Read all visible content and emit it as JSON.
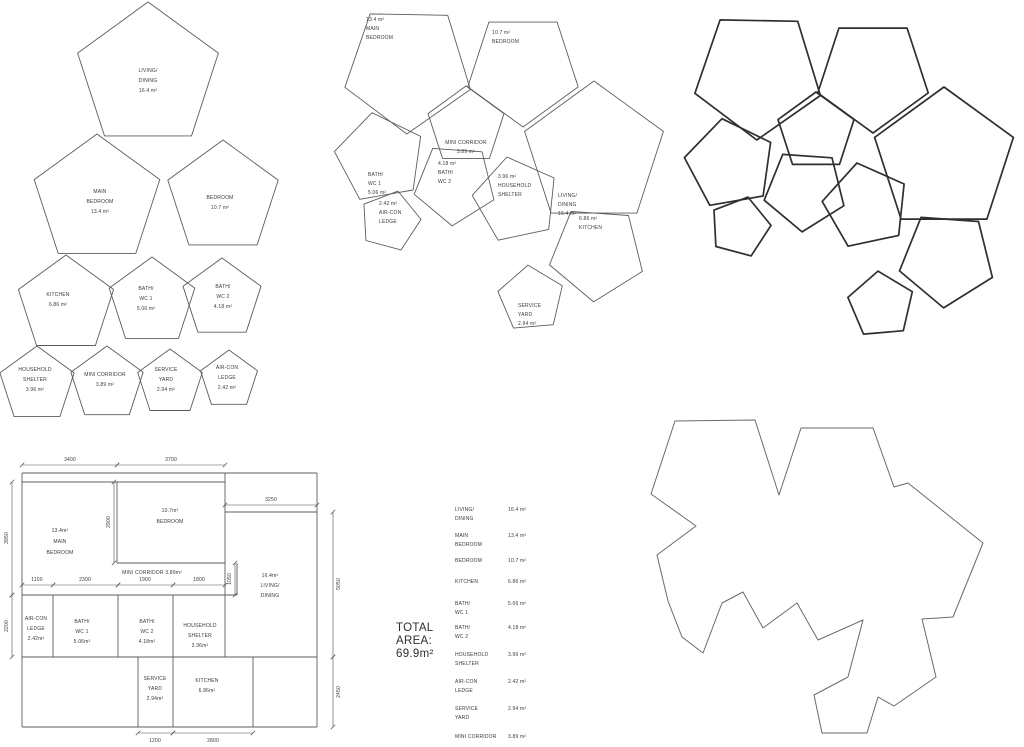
{
  "colors": {
    "thin_line": "#5c5c5c",
    "thick_line": "#2f2f2f",
    "outline_line": "#6a6a6a",
    "text": "#3a3a3a",
    "dim_line": "#4f4f4f"
  },
  "exploded_view": {
    "pentagons": [
      {
        "id": "living-dining",
        "cx": 148,
        "cy": 76,
        "r": 74,
        "rot": 0,
        "label": {
          "x": 148,
          "y": 72,
          "anchor": "middle",
          "step": 10,
          "lines": [
            "LIVING/",
            "DINING",
            "16.4 m²"
          ]
        }
      },
      {
        "id": "main-bedroom",
        "cx": 97,
        "cy": 200,
        "r": 66,
        "rot": 0,
        "label": {
          "x": 100,
          "y": 193,
          "anchor": "middle",
          "step": 10,
          "lines": [
            "MAIN",
            "BEDROOM",
            "13.4 m²"
          ]
        }
      },
      {
        "id": "bedroom",
        "cx": 223,
        "cy": 198,
        "r": 58,
        "rot": 0,
        "label": {
          "x": 220,
          "y": 199,
          "anchor": "middle",
          "step": 10,
          "lines": [
            "BEDROOM",
            "10.7 m²"
          ]
        }
      },
      {
        "id": "kitchen",
        "cx": 66,
        "cy": 305,
        "r": 50,
        "rot": 0,
        "label": {
          "x": 58,
          "y": 296,
          "anchor": "middle",
          "step": 10,
          "lines": [
            "KITCHEN",
            "6.86 m²"
          ]
        }
      },
      {
        "id": "bath-wc-1",
        "cx": 152,
        "cy": 302,
        "r": 45,
        "rot": 0,
        "label": {
          "x": 146,
          "y": 290,
          "anchor": "middle",
          "step": 10,
          "lines": [
            "BATH/",
            "WC 1",
            "5.06 m²"
          ]
        }
      },
      {
        "id": "bath-wc-2",
        "cx": 222,
        "cy": 299,
        "r": 41,
        "rot": 0,
        "label": {
          "x": 223,
          "y": 288,
          "anchor": "middle",
          "step": 10,
          "lines": [
            "BATH/",
            "WC 2",
            "4.18 m²"
          ]
        }
      },
      {
        "id": "household-shelter",
        "cx": 37,
        "cy": 385,
        "r": 39,
        "rot": 0,
        "label": {
          "x": 35,
          "y": 371,
          "anchor": "middle",
          "step": 10,
          "lines": [
            "HOUSEHOLD",
            "SHELTER",
            "3.96 m²"
          ]
        }
      },
      {
        "id": "mini-corridor",
        "cx": 107,
        "cy": 384,
        "r": 38,
        "rot": 0,
        "label": {
          "x": 105,
          "y": 376,
          "anchor": "middle",
          "step": 10,
          "lines": [
            "MINI CORRIDOR",
            "3.89 m²"
          ]
        }
      },
      {
        "id": "service-yard",
        "cx": 170,
        "cy": 383,
        "r": 34,
        "rot": 0,
        "label": {
          "x": 166,
          "y": 371,
          "anchor": "middle",
          "step": 10,
          "lines": [
            "SERVICE",
            "YARD",
            "2.94 m²"
          ]
        }
      },
      {
        "id": "air-con-ledge",
        "cx": 229,
        "cy": 380,
        "r": 30,
        "rot": 0,
        "label": {
          "x": 227,
          "y": 369,
          "anchor": "middle",
          "step": 10,
          "lines": [
            "AIR-CON",
            "LEDGE",
            "2.42 m²"
          ]
        }
      }
    ]
  },
  "assembled_view": {
    "pentagons": [
      {
        "id": "main-bedroom",
        "cx": 408,
        "cy": 68,
        "r": 66,
        "rot": 37,
        "label": {
          "x": 366,
          "y": 21,
          "anchor": "start",
          "step": 9,
          "lines": [
            "13.4 m²",
            "MAIN",
            "BEDROOM"
          ]
        }
      },
      {
        "id": "bedroom",
        "cx": 523,
        "cy": 69,
        "r": 58,
        "rot": 36,
        "label": {
          "x": 492,
          "y": 34,
          "anchor": "start",
          "step": 9,
          "lines": [
            "10.7 m²",
            "BEDROOM"
          ]
        }
      },
      {
        "id": "mini-corridor",
        "cx": 466,
        "cy": 126,
        "r": 40,
        "rot": 0,
        "label": {
          "x": 466,
          "y": 144,
          "anchor": "middle",
          "step": 9,
          "lines": [
            "MINI CORRIDOR",
            "3.89 m²"
          ]
        }
      },
      {
        "id": "bath-wc-1",
        "cx": 380,
        "cy": 158,
        "r": 46,
        "rot": -10,
        "label": {
          "x": 368,
          "y": 176,
          "anchor": "start",
          "step": 9,
          "lines": [
            "BATH/",
            "WC 1",
            "5.06 m²"
          ]
        }
      },
      {
        "id": "air-con-ledge",
        "cx": 390,
        "cy": 221,
        "r": 31,
        "rot": 15,
        "label": {
          "x": 379,
          "y": 205,
          "anchor": "start",
          "step": 9,
          "lines": [
            "2.42 m²",
            "AIR-CON",
            "LEDGE"
          ]
        }
      },
      {
        "id": "bath-wc-2",
        "cx": 455,
        "cy": 184,
        "r": 42,
        "rot": 40,
        "label": {
          "x": 438,
          "y": 165,
          "anchor": "start",
          "step": 9,
          "lines": [
            "4.18 m²",
            "BATH/",
            "WC 2"
          ]
        }
      },
      {
        "id": "household-shelter",
        "cx": 516,
        "cy": 200,
        "r": 44,
        "rot": -12,
        "label": {
          "x": 498,
          "y": 178,
          "anchor": "start",
          "step": 9,
          "lines": [
            "3.96 m²",
            "HOUSEHOLD",
            "SHELTER"
          ]
        }
      },
      {
        "id": "living-dining",
        "cx": 594,
        "cy": 154,
        "r": 73,
        "rot": 0,
        "label": {
          "x": 558,
          "y": 197,
          "anchor": "start",
          "step": 9,
          "lines": [
            "LIVING/",
            "DINING",
            "16.4 m²"
          ]
        }
      },
      {
        "id": "kitchen",
        "cx": 597,
        "cy": 253,
        "r": 49,
        "rot": 40,
        "label": {
          "x": 579,
          "y": 220,
          "anchor": "start",
          "step": 9,
          "lines": [
            "6.86 m²",
            "KITCHEN"
          ]
        }
      },
      {
        "id": "service-yard",
        "cx": 531,
        "cy": 299,
        "r": 34,
        "rot": -5,
        "label": {
          "x": 518,
          "y": 307,
          "anchor": "start",
          "step": 9,
          "lines": [
            "SERVICE",
            "YARD",
            "2.94 m²"
          ]
        }
      }
    ]
  },
  "outline_view": {
    "dx": 350,
    "dy": 6
  },
  "floor_plan": {
    "walls": [
      [
        22,
        473,
        317,
        473
      ],
      [
        22,
        482,
        225,
        482
      ],
      [
        225,
        512,
        317,
        512
      ],
      [
        117,
        563,
        225,
        563
      ],
      [
        22,
        595,
        237,
        595
      ],
      [
        22,
        657,
        317,
        657
      ],
      [
        22,
        727,
        317,
        727
      ],
      [
        22,
        473,
        22,
        727
      ],
      [
        317,
        473,
        317,
        727
      ],
      [
        117,
        482,
        117,
        563
      ],
      [
        225,
        473,
        225,
        657
      ],
      [
        237,
        563,
        237,
        595
      ],
      [
        53,
        595,
        53,
        657
      ],
      [
        118,
        595,
        118,
        657
      ],
      [
        173,
        595,
        173,
        657
      ],
      [
        138,
        657,
        138,
        727
      ],
      [
        173,
        657,
        173,
        727
      ],
      [
        253,
        657,
        253,
        727
      ]
    ],
    "dims": [
      {
        "x1": 22,
        "y1": 465,
        "x2": 117,
        "y2": 465,
        "label": "3400",
        "lx": 70,
        "ly": 461,
        "rot": 0
      },
      {
        "x1": 117,
        "y1": 465,
        "x2": 225,
        "y2": 465,
        "label": "3700",
        "lx": 171,
        "ly": 461,
        "rot": 0
      },
      {
        "x1": 225,
        "y1": 505,
        "x2": 317,
        "y2": 505,
        "label": "3250",
        "lx": 271,
        "ly": 501,
        "rot": 0
      },
      {
        "x1": 12,
        "y1": 482,
        "x2": 12,
        "y2": 595,
        "label": "3950",
        "lx": 8,
        "ly": 538,
        "rot": -90
      },
      {
        "x1": 12,
        "y1": 595,
        "x2": 12,
        "y2": 657,
        "label": "2200",
        "lx": 8,
        "ly": 626,
        "rot": -90
      },
      {
        "x1": 333,
        "y1": 512,
        "x2": 333,
        "y2": 657,
        "label": "5050",
        "lx": 340,
        "ly": 584,
        "rot": -90
      },
      {
        "x1": 333,
        "y1": 657,
        "x2": 333,
        "y2": 727,
        "label": "2450",
        "lx": 340,
        "ly": 692,
        "rot": -90
      },
      {
        "x1": 114,
        "y1": 482,
        "x2": 114,
        "y2": 563,
        "label": "2900",
        "lx": 110,
        "ly": 522,
        "rot": -90
      },
      {
        "x1": 235,
        "y1": 563,
        "x2": 235,
        "y2": 595,
        "label": "1050",
        "lx": 231,
        "ly": 579,
        "rot": -90
      },
      {
        "x1": 22,
        "y1": 585,
        "x2": 53,
        "y2": 585,
        "label": "1100",
        "lx": 37,
        "ly": 581,
        "rot": 0
      },
      {
        "x1": 53,
        "y1": 585,
        "x2": 118,
        "y2": 585,
        "label": "2300",
        "lx": 85,
        "ly": 581,
        "rot": 0
      },
      {
        "x1": 118,
        "y1": 585,
        "x2": 173,
        "y2": 585,
        "label": "1900",
        "lx": 145,
        "ly": 581,
        "rot": 0
      },
      {
        "x1": 173,
        "y1": 585,
        "x2": 225,
        "y2": 585,
        "label": "1800",
        "lx": 199,
        "ly": 581,
        "rot": 0
      },
      {
        "x1": 138,
        "y1": 733,
        "x2": 173,
        "y2": 733,
        "label": "1200",
        "lx": 155,
        "ly": 742,
        "rot": 0
      },
      {
        "x1": 173,
        "y1": 733,
        "x2": 253,
        "y2": 733,
        "label": "2800",
        "lx": 213,
        "ly": 742,
        "rot": 0
      }
    ],
    "rooms": [
      {
        "id": "main-bedroom",
        "x": 60,
        "y": 532,
        "step": 11,
        "lines": [
          "13.4m²",
          "MAIN",
          "BEDROOM"
        ]
      },
      {
        "id": "bedroom",
        "x": 170,
        "y": 512,
        "step": 11,
        "lines": [
          "10.7m²",
          "BEDROOM"
        ]
      },
      {
        "id": "mini-corridor",
        "x": 152,
        "y": 574,
        "step": 10,
        "lines": [
          "MINI CORRIDOR 3.89m²"
        ]
      },
      {
        "id": "living-dining",
        "x": 270,
        "y": 577,
        "step": 10,
        "lines": [
          "16.4m²",
          "LIVING/",
          "DINING"
        ]
      },
      {
        "id": "air-con-ledge",
        "x": 36,
        "y": 620,
        "step": 10,
        "lines": [
          "AIR-CON",
          "LEDGE",
          "2.42m²"
        ]
      },
      {
        "id": "bath-wc-1",
        "x": 82,
        "y": 623,
        "step": 10,
        "lines": [
          "BATH/",
          "WC 1",
          "5.06m²"
        ]
      },
      {
        "id": "bath-wc-2",
        "x": 147,
        "y": 623,
        "step": 10,
        "lines": [
          "BATH/",
          "WC 2",
          "4.18m²"
        ]
      },
      {
        "id": "household-shelter",
        "x": 200,
        "y": 627,
        "step": 10,
        "lines": [
          "HOUSEHOLD",
          "SHELTER",
          "3.96m²"
        ]
      },
      {
        "id": "service-yard",
        "x": 155,
        "y": 680,
        "step": 10,
        "lines": [
          "SERVICE",
          "YARD",
          "2.94m²"
        ]
      },
      {
        "id": "kitchen",
        "x": 207,
        "y": 682,
        "step": 10,
        "lines": [
          "KITCHEN",
          "6.86m²"
        ]
      }
    ]
  },
  "area_table": {
    "total_lines": [
      "TOTAL",
      "AREA:",
      "69.9m²"
    ],
    "label_x": 455,
    "value_x": 508,
    "step": 9,
    "rows": [
      {
        "lines": [
          "LIVING/",
          "DINING"
        ],
        "value": "16.4 m²",
        "y": 511
      },
      {
        "lines": [
          "MAIN",
          "BEDROOM"
        ],
        "value": "13.4 m²",
        "y": 537
      },
      {
        "lines": [
          "BEDROOM"
        ],
        "value": "10.7 m²",
        "y": 562
      },
      {
        "lines": [
          "KITCHEN"
        ],
        "value": "6.86 m²",
        "y": 583
      },
      {
        "lines": [
          "BATH/",
          "WC 1"
        ],
        "value": "5.06 m²",
        "y": 605
      },
      {
        "lines": [
          "BATH/",
          "WC 2"
        ],
        "value": "4.18 m²",
        "y": 629
      },
      {
        "lines": [
          "HOUSEHOLD",
          "SHELTER"
        ],
        "value": "3.96 m²",
        "y": 656
      },
      {
        "lines": [
          "AIR-CON",
          "LEDGE"
        ],
        "value": "2.42 m²",
        "y": 683
      },
      {
        "lines": [
          "SERVICE",
          "YARD"
        ],
        "value": "2.94 m²",
        "y": 710
      },
      {
        "lines": [
          "MINI CORRIDOR"
        ],
        "value": "3.89 m²",
        "y": 738
      }
    ]
  },
  "silhouette": {
    "points": [
      [
        675,
        421
      ],
      [
        755,
        420
      ],
      [
        779,
        495
      ],
      [
        801,
        428
      ],
      [
        873,
        428
      ],
      [
        894,
        487
      ],
      [
        908,
        483
      ],
      [
        983,
        543
      ],
      [
        953,
        617
      ],
      [
        922,
        619
      ],
      [
        936,
        677
      ],
      [
        894,
        706
      ],
      [
        878,
        697
      ],
      [
        867,
        733
      ],
      [
        822,
        733
      ],
      [
        814,
        695
      ],
      [
        848,
        677
      ],
      [
        863,
        620
      ],
      [
        818,
        640
      ],
      [
        797,
        603
      ],
      [
        763,
        628
      ],
      [
        743,
        592
      ],
      [
        722,
        603
      ],
      [
        703,
        653
      ],
      [
        682,
        637
      ],
      [
        668,
        601
      ],
      [
        657,
        555
      ],
      [
        696,
        526
      ],
      [
        651,
        494
      ]
    ]
  }
}
